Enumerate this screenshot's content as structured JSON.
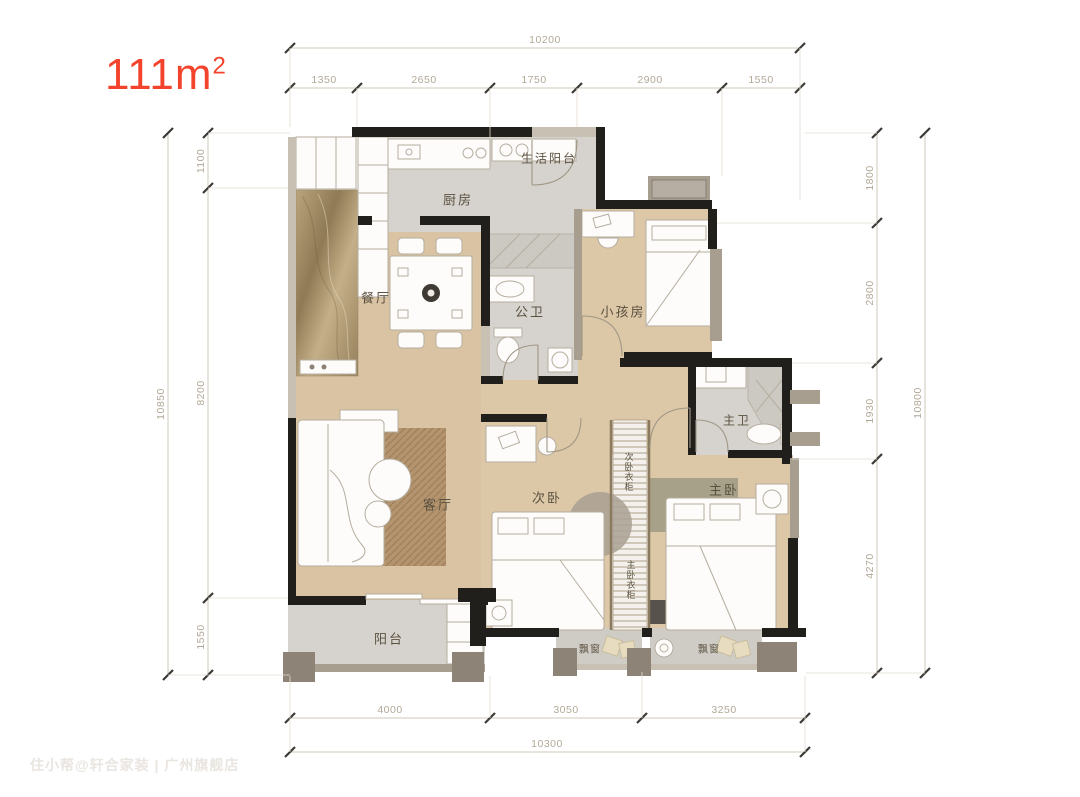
{
  "title": {
    "value": "111m",
    "sup": "2"
  },
  "watermark": "住小帮@轩合家装 | 广州旗舰店",
  "rooms": {
    "kitchen": "厨房",
    "utility_balcony": "生活阳台",
    "dining": "餐厅",
    "guest_bath": "公卫",
    "kids_room": "小孩房",
    "living": "客厅",
    "second_bedroom": "次卧",
    "second_wardrobe": "次卧衣柜",
    "master_wardrobe": "主卧衣柜",
    "master_bath": "主卫",
    "master_bedroom": "主卧",
    "balcony": "阳台",
    "bay_window_left": "飘窗",
    "bay_window_right": "飘窗"
  },
  "dimensions": {
    "top": {
      "total": "10200",
      "segments": [
        "1350",
        "2650",
        "1750",
        "2900",
        "1550"
      ]
    },
    "bottom": {
      "total": "10300",
      "segments": [
        "4000",
        "3050",
        "3250"
      ]
    },
    "left": {
      "total": "10850",
      "segments": [
        "1100",
        "8200",
        "1550"
      ]
    },
    "right": {
      "total": "10800",
      "segments": [
        "1800",
        "2800",
        "1930",
        "4270"
      ]
    }
  },
  "colors": {
    "accent": "#f4432c",
    "wall": "#211f1c",
    "wood_floor": "#d9c3a2",
    "tile_floor": "#d6d3ce",
    "dim_text": "#b3a898"
  }
}
